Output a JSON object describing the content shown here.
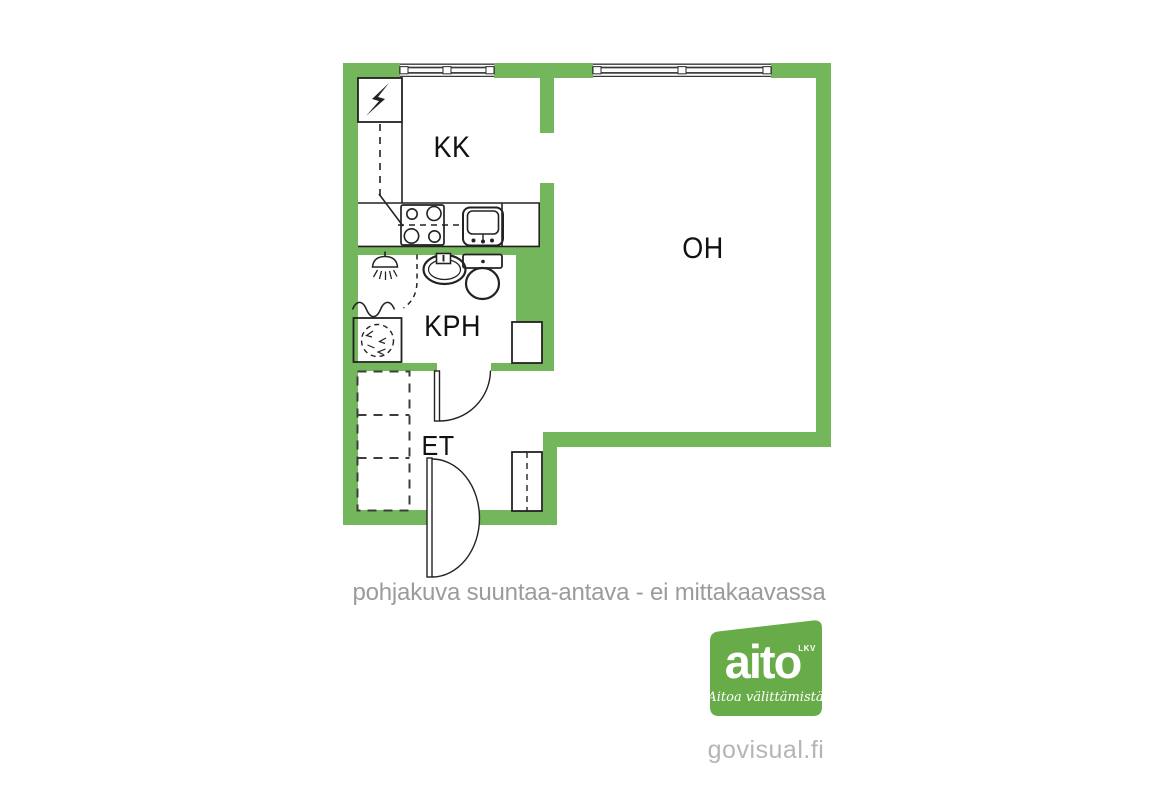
{
  "theme": {
    "wall": "#74b65b",
    "line": "#222222",
    "dash": "#3c3c3c",
    "label": "#111111",
    "disclaimer": "#9b9b9b",
    "website": "#b5b5b5",
    "logo": "#68ac49"
  },
  "floorplan": {
    "rooms": {
      "kk": {
        "label": "KK"
      },
      "oh": {
        "label": "OH"
      },
      "kph": {
        "label": "KPH"
      },
      "et": {
        "label": "ET"
      }
    },
    "symbols": [
      "window-symbol",
      "electrical-panel-symbol",
      "kitchen-counter",
      "stove-symbol",
      "kitchen-sink-symbol",
      "shower-symbol",
      "shower-curtain-line",
      "washing-machine-reservation-symbol",
      "washbasin-symbol",
      "toilet-symbol",
      "wardrobe-symbol",
      "duct-shaft",
      "hall-cabinet",
      "interior-door-swing",
      "entrance-door-swing"
    ],
    "disclaimer": "pohjakuva suuntaa-antava - ei mittakaavassa"
  },
  "branding": {
    "name": "aito",
    "suffix": "LKV",
    "tagline": "Aitoa välittämistä",
    "website": "govisual.fi"
  }
}
